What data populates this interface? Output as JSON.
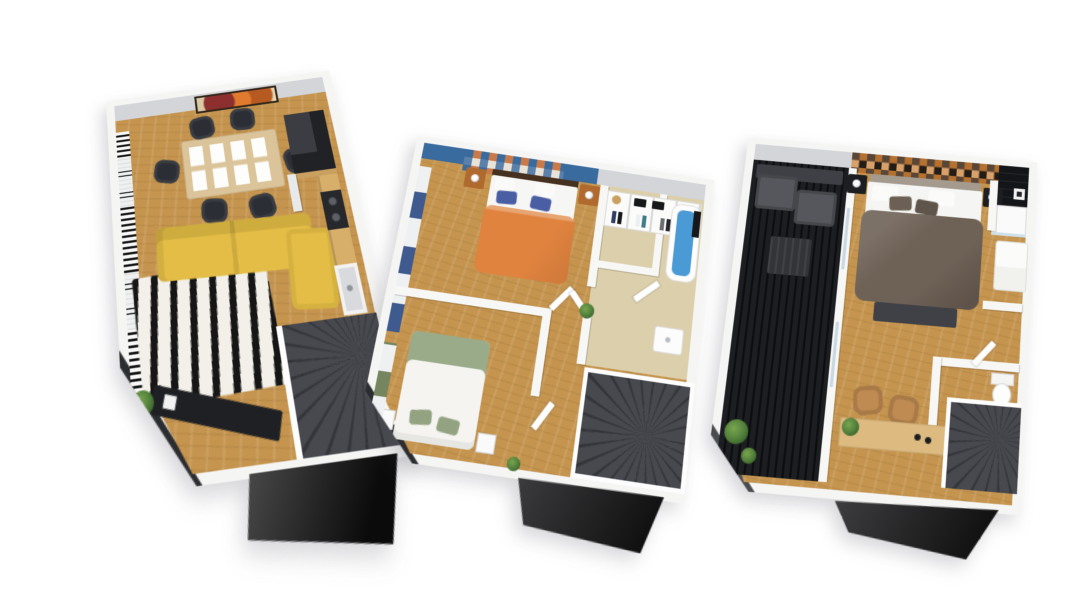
{
  "canvas": {
    "width": 1080,
    "height": 608,
    "background": "#ffffff"
  },
  "palette": {
    "bg": "#ffffff",
    "wall": "#f5f5f4",
    "wallFace": "#d4d5d9",
    "floorWood": "#c5954f",
    "floorWoodLight": "#d8ae6b",
    "floorTile": "#dccfab",
    "slab": "#2c2d30",
    "stairs": "#47494e",
    "stairLine": "#33353a",
    "wedgeDark": "#0b0b0c",
    "wedgeLight": "#4c4c4c",
    "sofaYellow": "#e3bd45",
    "rugWhite": "#f2f0e8",
    "rugBlack": "#161616",
    "tableWood": "#dcc49a",
    "chairBlack": "#2b2e34",
    "consoleBlack": "#1f2023",
    "artFrame": "#33261a",
    "accentBlue": "#3a6b9e",
    "bedOrange": "#e0833f",
    "pillowBlue": "#4a5fa3",
    "nightWood": "#b06a2e",
    "curtainBlue": "#3f5a8f",
    "sageGreen": "#9aab8a",
    "curtainGreen": "#75855f",
    "tubBlue": "#4a9ad6",
    "terraceBlack": "#17181b",
    "outdoorGray": "#55575c",
    "bedTaupe": "#6e6156",
    "headboardTaupe": "#a49b8e",
    "headboardBrown": "#463121",
    "accentCopper": "#b5712f",
    "accentTan": "#d8a169",
    "accentDark": "#241c17",
    "deskWood": "#dcba80",
    "chairTan": "#c08b52",
    "plantGreen": "#4e7d3a"
  },
  "floors": [
    {
      "id": "floor-1",
      "level": 1,
      "rooms": [
        "living-dining-room",
        "kitchen",
        "staircase"
      ],
      "furniture": [
        "abstract wall art",
        "dining table with 8 placemats",
        "6 black dining chairs",
        "yellow corner sofa with chaise",
        "zebra rug",
        "black tv console",
        "potted plant",
        "kitchen counter with sink and cooktop",
        "tall dark kitchen unit",
        "black and white curtains with blinds",
        "dark winder staircase"
      ]
    },
    {
      "id": "floor-2",
      "level": 2,
      "rooms": [
        "master-bedroom",
        "second-bedroom",
        "walk-in-closet",
        "bathroom",
        "hallway",
        "staircase"
      ],
      "furniture": [
        "blue accent wall with triangle quilt art",
        "orange double bed with blue and white pillows",
        "wood nightstands with lamps",
        "blue curtains",
        "white and sage double bed",
        "white nightstands with lamps",
        "green curtains",
        "white wardrobe shelving with clothes and bags",
        "blue bathtub",
        "black shower fixture",
        "white sink",
        "open doors",
        "dark winder staircase",
        "potted plants"
      ]
    },
    {
      "id": "floor-3",
      "level": 3,
      "rooms": [
        "master-bedroom",
        "terrace",
        "shower-room",
        "wc",
        "staircase"
      ],
      "furniture": [
        "dark slatted terrace deck",
        "gray outdoor sofa",
        "dark coffee table",
        "terrace plants",
        "copper mosaic accent wall",
        "taupe double bed with white pillows",
        "foot bench",
        "black nightstands with lamps",
        "black tiled shower with white tray",
        "white vanity unit",
        "toilet",
        "wood desk with two tan chairs",
        "white cabinet",
        "dark winder staircase"
      ]
    }
  ]
}
